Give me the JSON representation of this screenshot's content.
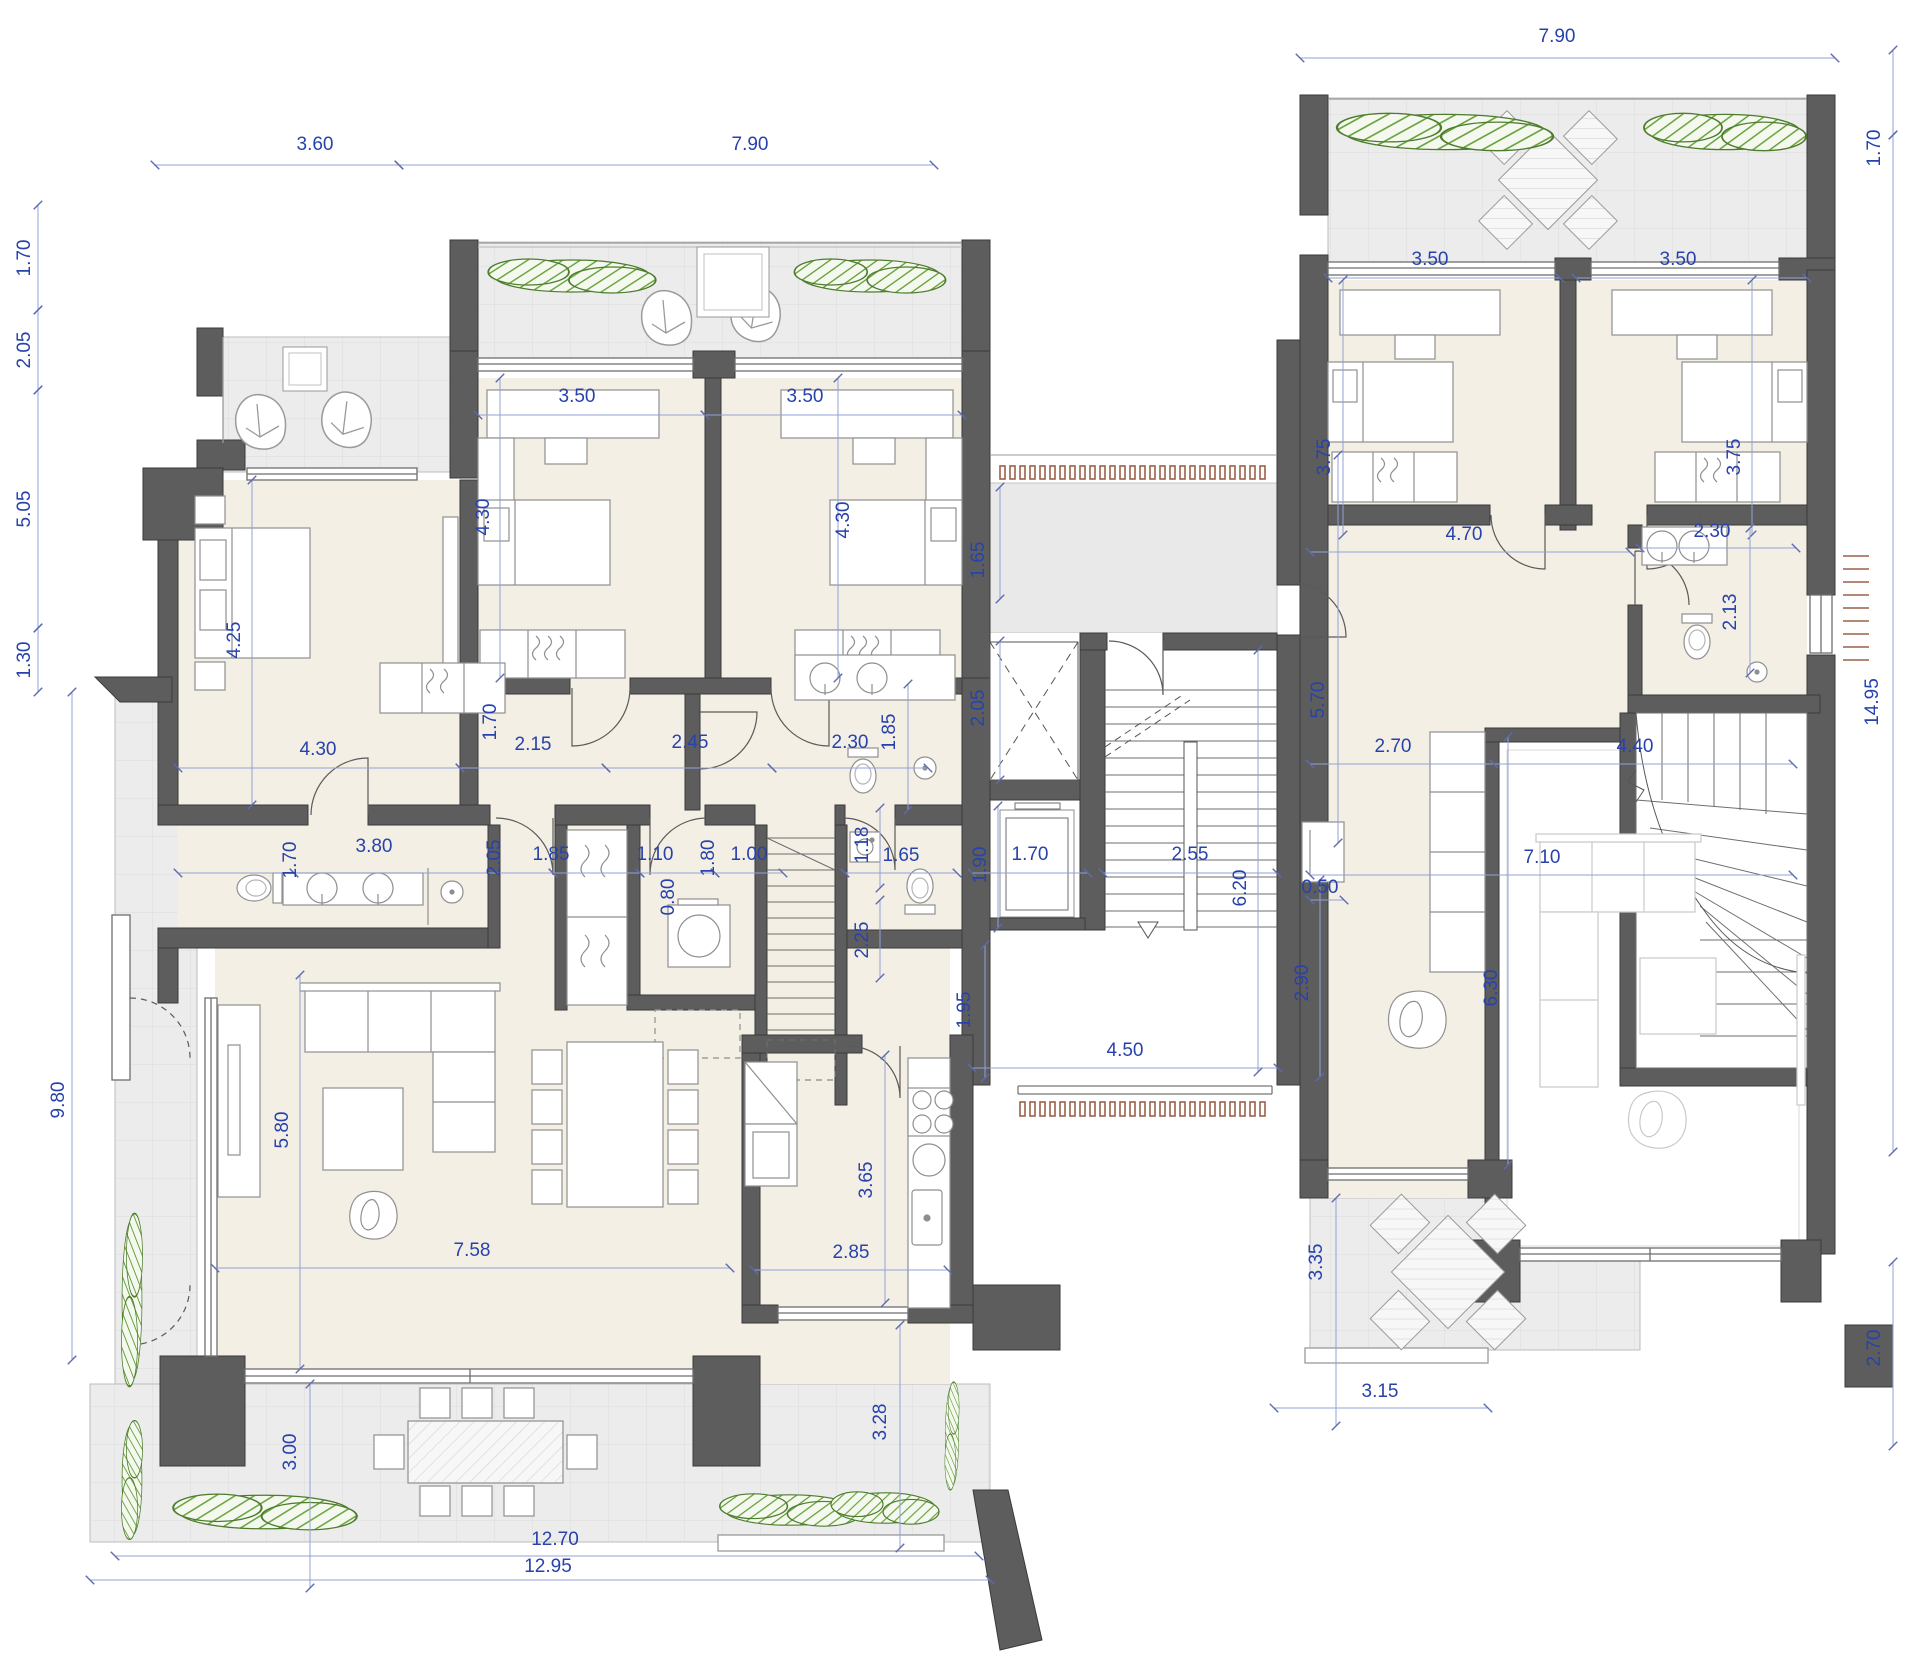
{
  "document": {
    "kind": "architectural floor plan",
    "units": "meters",
    "sheet": "two residential units with central stair / elevator core, terraces and gardens"
  },
  "colors": {
    "wall": "#5d5d5d",
    "wall_edge": "#3a3a3a",
    "interior_floor": "#f3efe4",
    "terrace_floor": "#ececec",
    "tile_line": "#dcdcdc",
    "dimension_text": "#2742ad",
    "dimension_line": "#93a1d6",
    "furniture_stroke": "#8f8f8f",
    "light_furniture_stroke": "#c9c9c9",
    "plant_green": "#69a33e",
    "plant_outline": "#4e7c2e",
    "wood_tick_brown": "#9b6148"
  },
  "dimensions": {
    "labels": [
      {
        "t": "7.90",
        "x": 1557,
        "y": 42,
        "r": 0
      },
      {
        "t": "3.60",
        "x": 315,
        "y": 150,
        "r": 0
      },
      {
        "t": "7.90",
        "x": 750,
        "y": 150,
        "r": 0
      },
      {
        "t": "3.50",
        "x": 577,
        "y": 402,
        "r": 0
      },
      {
        "t": "3.50",
        "x": 805,
        "y": 402,
        "r": 0
      },
      {
        "t": "3.50",
        "x": 1430,
        "y": 265,
        "r": 0
      },
      {
        "t": "3.50",
        "x": 1678,
        "y": 265,
        "r": 0
      },
      {
        "t": "4.30",
        "x": 318,
        "y": 755,
        "r": 0
      },
      {
        "t": "2.15",
        "x": 533,
        "y": 750,
        "r": 0
      },
      {
        "t": "2.45",
        "x": 690,
        "y": 748,
        "r": 0
      },
      {
        "t": "2.30",
        "x": 850,
        "y": 748,
        "r": 0
      },
      {
        "t": "1.10",
        "x": 655,
        "y": 860,
        "r": 0
      },
      {
        "t": "1.00",
        "x": 749,
        "y": 860,
        "r": 0
      },
      {
        "t": "1.65",
        "x": 901,
        "y": 861,
        "r": 0
      },
      {
        "t": "1.70",
        "x": 1030,
        "y": 860,
        "r": 0
      },
      {
        "t": "2.55",
        "x": 1190,
        "y": 860,
        "r": 0
      },
      {
        "t": "4.50",
        "x": 1125,
        "y": 1056,
        "r": 0
      },
      {
        "t": "3.80",
        "x": 374,
        "y": 852,
        "r": 0
      },
      {
        "t": "1.85",
        "x": 551,
        "y": 860,
        "r": 0
      },
      {
        "t": "2.85",
        "x": 851,
        "y": 1258,
        "r": 0
      },
      {
        "t": "7.58",
        "x": 472,
        "y": 1256,
        "r": 0
      },
      {
        "t": "12.70",
        "x": 555,
        "y": 1545,
        "r": 0
      },
      {
        "t": "12.95",
        "x": 548,
        "y": 1572,
        "r": 0
      },
      {
        "t": "4.70",
        "x": 1464,
        "y": 540,
        "r": 0
      },
      {
        "t": "2.30",
        "x": 1712,
        "y": 537,
        "r": 0
      },
      {
        "t": "2.70",
        "x": 1393,
        "y": 752,
        "r": 0
      },
      {
        "t": "4.40",
        "x": 1635,
        "y": 752,
        "r": 0
      },
      {
        "t": "7.10",
        "x": 1542,
        "y": 863,
        "r": 0
      },
      {
        "t": "0.50",
        "x": 1320,
        "y": 893,
        "r": 0
      },
      {
        "t": "3.15",
        "x": 1380,
        "y": 1397,
        "r": 0
      },
      {
        "t": "1.70",
        "x": 30,
        "y": 258,
        "r": 270
      },
      {
        "t": "2.05",
        "x": 30,
        "y": 350,
        "r": 270
      },
      {
        "t": "5.05",
        "x": 30,
        "y": 509,
        "r": 270
      },
      {
        "t": "1.30",
        "x": 30,
        "y": 660,
        "r": 270
      },
      {
        "t": "9.80",
        "x": 64,
        "y": 1100,
        "r": 270
      },
      {
        "t": "4.30",
        "x": 489,
        "y": 517,
        "r": 270
      },
      {
        "t": "4.30",
        "x": 849,
        "y": 520,
        "r": 270
      },
      {
        "t": "4.25",
        "x": 240,
        "y": 640,
        "r": 270
      },
      {
        "t": "1.70",
        "x": 496,
        "y": 722,
        "r": 270
      },
      {
        "t": "1.85",
        "x": 895,
        "y": 732,
        "r": 270
      },
      {
        "t": "2.05",
        "x": 984,
        "y": 708,
        "r": 270
      },
      {
        "t": "1.65",
        "x": 984,
        "y": 560,
        "r": 270
      },
      {
        "t": "0.80",
        "x": 674,
        "y": 897,
        "r": 270
      },
      {
        "t": "1.80",
        "x": 714,
        "y": 858,
        "r": 270
      },
      {
        "t": "1.18",
        "x": 868,
        "y": 845,
        "r": 270
      },
      {
        "t": "1.90",
        "x": 986,
        "y": 865,
        "r": 270
      },
      {
        "t": "2.25",
        "x": 868,
        "y": 940,
        "r": 270
      },
      {
        "t": "1.95",
        "x": 970,
        "y": 1010,
        "r": 270
      },
      {
        "t": "6.20",
        "x": 1246,
        "y": 888,
        "r": 270
      },
      {
        "t": "2.90",
        "x": 1308,
        "y": 983,
        "r": 270
      },
      {
        "t": "5.70",
        "x": 1324,
        "y": 700,
        "r": 270
      },
      {
        "t": "3.65",
        "x": 872,
        "y": 1180,
        "r": 270
      },
      {
        "t": "5.80",
        "x": 288,
        "y": 1130,
        "r": 270
      },
      {
        "t": "1.70",
        "x": 296,
        "y": 860,
        "r": 270
      },
      {
        "t": "2.05",
        "x": 500,
        "y": 858,
        "r": 270
      },
      {
        "t": "3.00",
        "x": 296,
        "y": 1452,
        "r": 270
      },
      {
        "t": "3.28",
        "x": 886,
        "y": 1422,
        "r": 270
      },
      {
        "t": "3.35",
        "x": 1322,
        "y": 1262,
        "r": 270
      },
      {
        "t": "3.75",
        "x": 1330,
        "y": 457,
        "r": 270
      },
      {
        "t": "3.75",
        "x": 1740,
        "y": 457,
        "r": 270
      },
      {
        "t": "2.13",
        "x": 1736,
        "y": 612,
        "r": 270
      },
      {
        "t": "1.70",
        "x": 1880,
        "y": 148,
        "r": 270
      },
      {
        "t": "14.95",
        "x": 1878,
        "y": 702,
        "r": 270
      },
      {
        "t": "2.70",
        "x": 1880,
        "y": 1348,
        "r": 270
      },
      {
        "t": "6.30",
        "x": 1497,
        "y": 988,
        "r": 270
      }
    ],
    "lines": [
      {
        "x1": 1300,
        "y1": 58,
        "x2": 1835,
        "y2": 58
      },
      {
        "x1": 155,
        "y1": 165,
        "x2": 399,
        "y2": 165
      },
      {
        "x1": 399,
        "y1": 165,
        "x2": 934,
        "y2": 165
      },
      {
        "x1": 38,
        "y1": 205,
        "x2": 38,
        "y2": 310
      },
      {
        "x1": 38,
        "y1": 310,
        "x2": 38,
        "y2": 390
      },
      {
        "x1": 38,
        "y1": 390,
        "x2": 38,
        "y2": 628
      },
      {
        "x1": 38,
        "y1": 628,
        "x2": 38,
        "y2": 692
      },
      {
        "x1": 72,
        "y1": 692,
        "x2": 72,
        "y2": 1360
      },
      {
        "x1": 1893,
        "y1": 50,
        "x2": 1893,
        "y2": 135
      },
      {
        "x1": 1893,
        "y1": 135,
        "x2": 1893,
        "y2": 1152
      },
      {
        "x1": 1893,
        "y1": 1262,
        "x2": 1893,
        "y2": 1446
      },
      {
        "x1": 115,
        "y1": 1556,
        "x2": 979,
        "y2": 1556
      },
      {
        "x1": 90,
        "y1": 1580,
        "x2": 990,
        "y2": 1580
      },
      {
        "x1": 478,
        "y1": 415,
        "x2": 705,
        "y2": 415
      },
      {
        "x1": 705,
        "y1": 415,
        "x2": 962,
        "y2": 415
      },
      {
        "x1": 500,
        "y1": 378,
        "x2": 500,
        "y2": 678
      },
      {
        "x1": 838,
        "y1": 378,
        "x2": 838,
        "y2": 678
      },
      {
        "x1": 252,
        "y1": 480,
        "x2": 252,
        "y2": 805
      },
      {
        "x1": 178,
        "y1": 768,
        "x2": 460,
        "y2": 768
      },
      {
        "x1": 460,
        "y1": 768,
        "x2": 606,
        "y2": 768
      },
      {
        "x1": 606,
        "y1": 768,
        "x2": 772,
        "y2": 768
      },
      {
        "x1": 772,
        "y1": 768,
        "x2": 928,
        "y2": 768
      },
      {
        "x1": 178,
        "y1": 873,
        "x2": 294,
        "y2": 873
      },
      {
        "x1": 294,
        "y1": 873,
        "x2": 553,
        "y2": 873
      },
      {
        "x1": 553,
        "y1": 873,
        "x2": 640,
        "y2": 873
      },
      {
        "x1": 640,
        "y1": 873,
        "x2": 715,
        "y2": 873
      },
      {
        "x1": 715,
        "y1": 873,
        "x2": 783,
        "y2": 873
      },
      {
        "x1": 845,
        "y1": 873,
        "x2": 957,
        "y2": 873
      },
      {
        "x1": 972,
        "y1": 873,
        "x2": 1088,
        "y2": 873
      },
      {
        "x1": 1103,
        "y1": 873,
        "x2": 1277,
        "y2": 873
      },
      {
        "x1": 880,
        "y1": 808,
        "x2": 880,
        "y2": 888
      },
      {
        "x1": 880,
        "y1": 900,
        "x2": 880,
        "y2": 978
      },
      {
        "x1": 985,
        "y1": 945,
        "x2": 985,
        "y2": 1078
      },
      {
        "x1": 998,
        "y1": 806,
        "x2": 998,
        "y2": 928
      },
      {
        "x1": 972,
        "y1": 1068,
        "x2": 1278,
        "y2": 1068
      },
      {
        "x1": 1258,
        "y1": 650,
        "x2": 1258,
        "y2": 1072
      },
      {
        "x1": 1000,
        "y1": 641,
        "x2": 1000,
        "y2": 780
      },
      {
        "x1": 1000,
        "y1": 487,
        "x2": 1000,
        "y2": 599
      },
      {
        "x1": 908,
        "y1": 684,
        "x2": 908,
        "y2": 810
      },
      {
        "x1": 885,
        "y1": 1055,
        "x2": 885,
        "y2": 1303
      },
      {
        "x1": 754,
        "y1": 1270,
        "x2": 948,
        "y2": 1270
      },
      {
        "x1": 300,
        "y1": 975,
        "x2": 300,
        "y2": 1369
      },
      {
        "x1": 215,
        "y1": 1268,
        "x2": 730,
        "y2": 1268
      },
      {
        "x1": 310,
        "y1": 1384,
        "x2": 310,
        "y2": 1588
      },
      {
        "x1": 900,
        "y1": 1325,
        "x2": 900,
        "y2": 1548
      },
      {
        "x1": 1328,
        "y1": 278,
        "x2": 1560,
        "y2": 278
      },
      {
        "x1": 1576,
        "y1": 278,
        "x2": 1807,
        "y2": 278
      },
      {
        "x1": 1343,
        "y1": 280,
        "x2": 1343,
        "y2": 535
      },
      {
        "x1": 1752,
        "y1": 280,
        "x2": 1752,
        "y2": 535
      },
      {
        "x1": 1310,
        "y1": 552,
        "x2": 1630,
        "y2": 552
      },
      {
        "x1": 1640,
        "y1": 548,
        "x2": 1796,
        "y2": 548
      },
      {
        "x1": 1750,
        "y1": 528,
        "x2": 1750,
        "y2": 673
      },
      {
        "x1": 1338,
        "y1": 455,
        "x2": 1338,
        "y2": 843
      },
      {
        "x1": 1320,
        "y1": 880,
        "x2": 1320,
        "y2": 1077
      },
      {
        "x1": 1310,
        "y1": 900,
        "x2": 1344,
        "y2": 900
      },
      {
        "x1": 1310,
        "y1": 764,
        "x2": 1494,
        "y2": 764
      },
      {
        "x1": 1494,
        "y1": 764,
        "x2": 1793,
        "y2": 764
      },
      {
        "x1": 1310,
        "y1": 875,
        "x2": 1793,
        "y2": 875
      },
      {
        "x1": 1508,
        "y1": 737,
        "x2": 1508,
        "y2": 1165
      },
      {
        "x1": 1336,
        "y1": 1198,
        "x2": 1336,
        "y2": 1426
      },
      {
        "x1": 1274,
        "y1": 1408,
        "x2": 1488,
        "y2": 1408
      }
    ]
  }
}
